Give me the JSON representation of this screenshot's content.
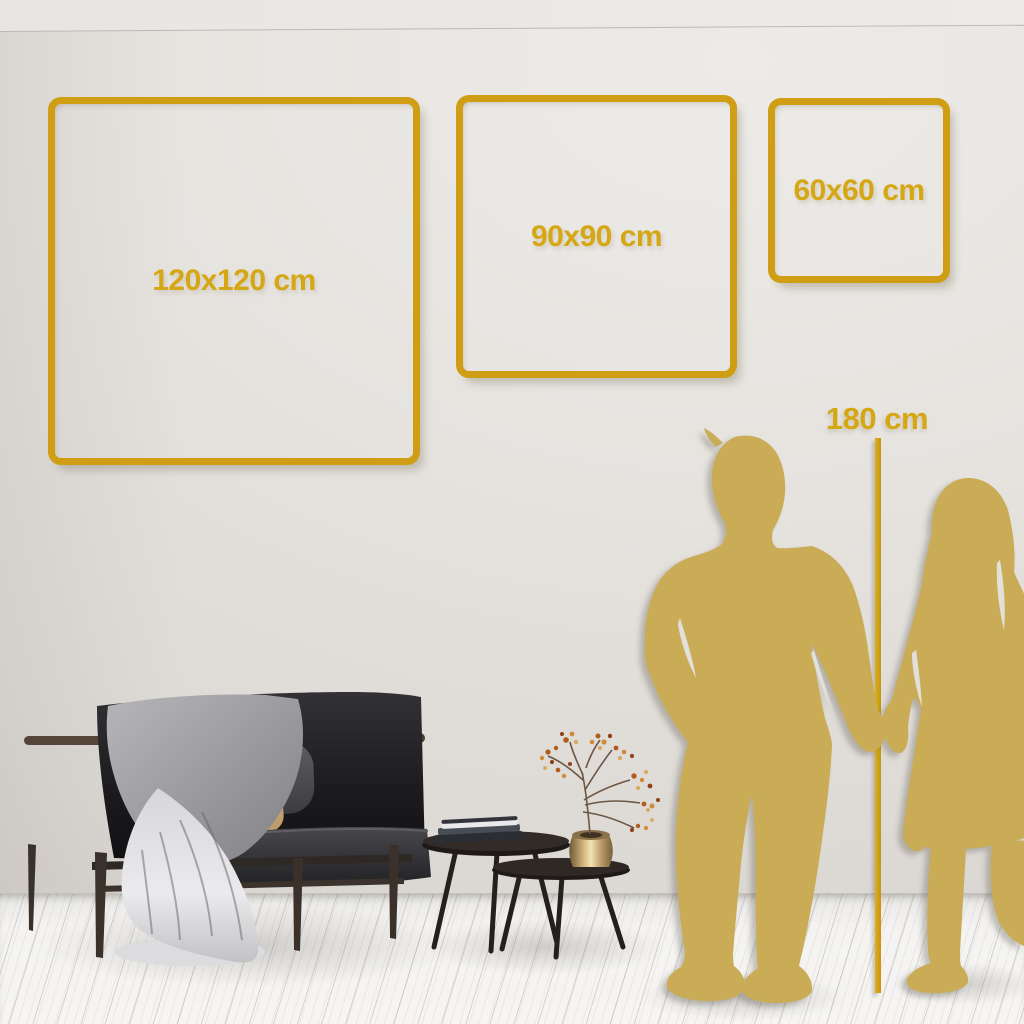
{
  "frames": [
    {
      "label": "120x120 cm"
    },
    {
      "label": "90x90 cm"
    },
    {
      "label": "60x60 cm"
    }
  ],
  "ruler": {
    "label": "180 cm"
  },
  "colors": {
    "gold": "#cf9e14",
    "gold_text": "#d6a715",
    "silhouette": "#c9ac55",
    "wall": "#e5e2de",
    "floor": "#f4f3f1"
  }
}
